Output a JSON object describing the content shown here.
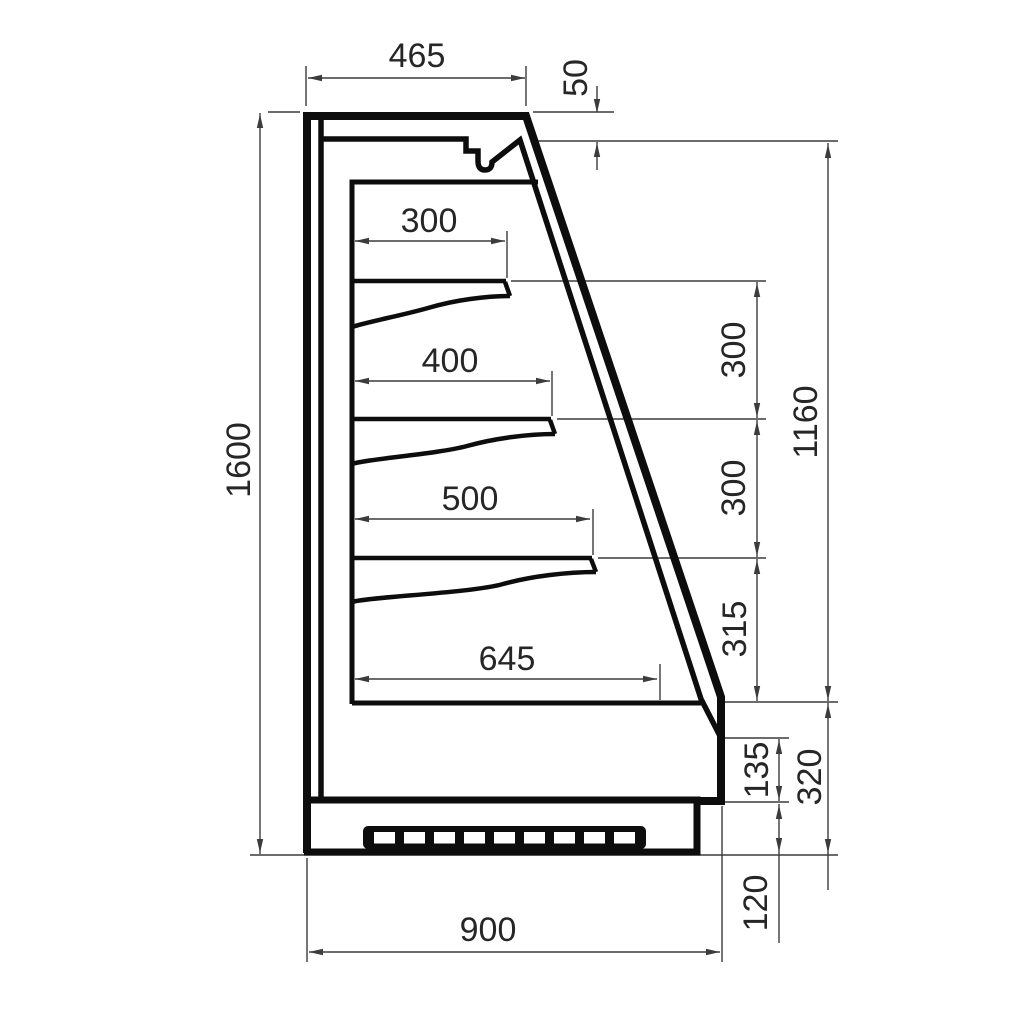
{
  "drawing": {
    "bg": "#ffffff",
    "line_color": "#0d0d0d",
    "dim_line_color": "#3c3c3c",
    "text_color": "#262626"
  },
  "dims": {
    "top_depth": "465",
    "canopy_drop": "50",
    "shelf1_depth": "300",
    "shelf2_depth": "400",
    "shelf3_depth": "500",
    "bottom_shelf_depth": "645",
    "overall_height": "1600",
    "shelf_spacing_upper": "300",
    "shelf_spacing_lower": "300",
    "bottom_spacing": "315",
    "front_opening_height": "1160",
    "front_panel_height": "135",
    "base_section_height": "320",
    "plinth_recess_height": "120",
    "overall_depth": "900"
  }
}
